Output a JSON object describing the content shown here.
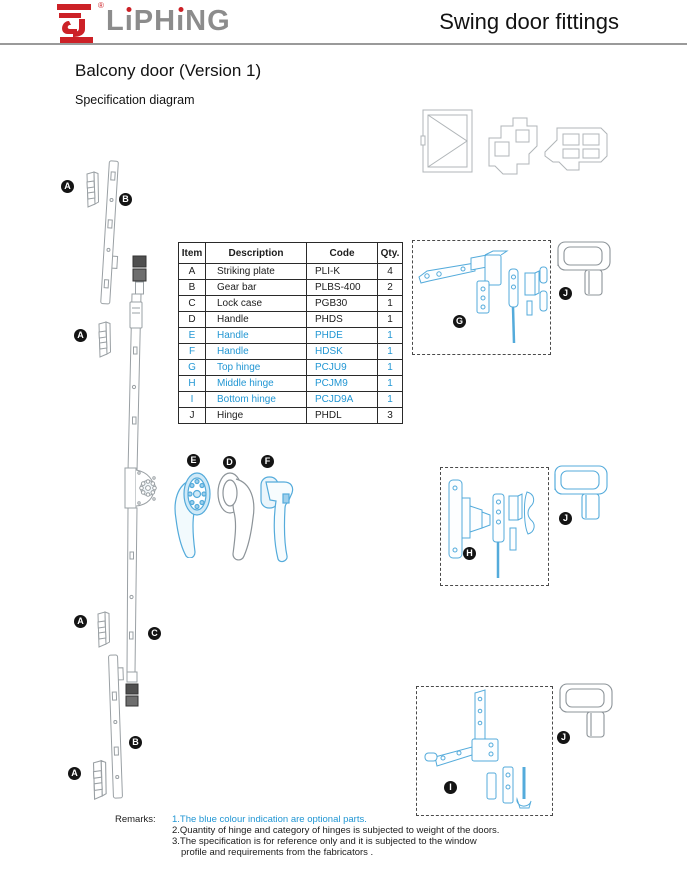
{
  "header": {
    "brand": "LiPHiNG",
    "brand_parts": [
      "L",
      "ı",
      "PH",
      "ı",
      "NG"
    ],
    "registered_mark": "®",
    "title": "Swing door fittings"
  },
  "page": {
    "title": "Balcony door (Version 1)",
    "subtitle": "Specification diagram"
  },
  "table": {
    "headers": [
      "Item",
      "Description",
      "Code",
      "Qty."
    ],
    "rows": [
      {
        "item": "A",
        "description": "Striking plate",
        "code": "PLI-K",
        "qty": "4",
        "optional": false
      },
      {
        "item": "B",
        "description": "Gear bar",
        "code": "PLBS-400",
        "qty": "2",
        "optional": false
      },
      {
        "item": "C",
        "description": "Lock case",
        "code": "PGB30",
        "qty": "1",
        "optional": false
      },
      {
        "item": "D",
        "description": "Handle",
        "code": "PHDS",
        "qty": "1",
        "optional": false
      },
      {
        "item": "E",
        "description": "Handle",
        "code": "PHDE",
        "qty": "1",
        "optional": true
      },
      {
        "item": "F",
        "description": "Handle",
        "code": "HDSK",
        "qty": "1",
        "optional": true
      },
      {
        "item": "G",
        "description": "Top hinge",
        "code": "PCJU9",
        "qty": "1",
        "optional": true
      },
      {
        "item": "H",
        "description": "Middle hinge",
        "code": "PCJM9",
        "qty": "1",
        "optional": true
      },
      {
        "item": "I",
        "description": "Bottom hinge",
        "code": "PCJD9A",
        "qty": "1",
        "optional": true
      },
      {
        "item": "J",
        "description": "Hinge",
        "code": "PHDL",
        "qty": "3",
        "optional": false
      }
    ]
  },
  "diagram": {
    "labels": {
      "a1": "A",
      "b1": "B",
      "a2": "A",
      "e": "E",
      "d": "D",
      "f": "F",
      "a3": "A",
      "c": "C",
      "b2": "B",
      "a4": "A",
      "g": "G",
      "j1": "J",
      "h": "H",
      "j2": "J",
      "i": "I",
      "j3": "J"
    }
  },
  "remarks": {
    "label": "Remarks:",
    "lines": [
      "1.The blue colour indication are optional parts.",
      "2.Quantity of hinge and category of hinges is subjected to weight of the doors.",
      "3.The specification is for reference only and it is subjected to the window",
      "profile and requirements from the fabricators ."
    ]
  },
  "colors": {
    "optional_blue": "#2196d3",
    "brand_red": "#cc2127",
    "brand_gray": "#8c8c8c",
    "drawing_gray": "#9aa0a4",
    "drawing_blue": "#54abdb"
  }
}
